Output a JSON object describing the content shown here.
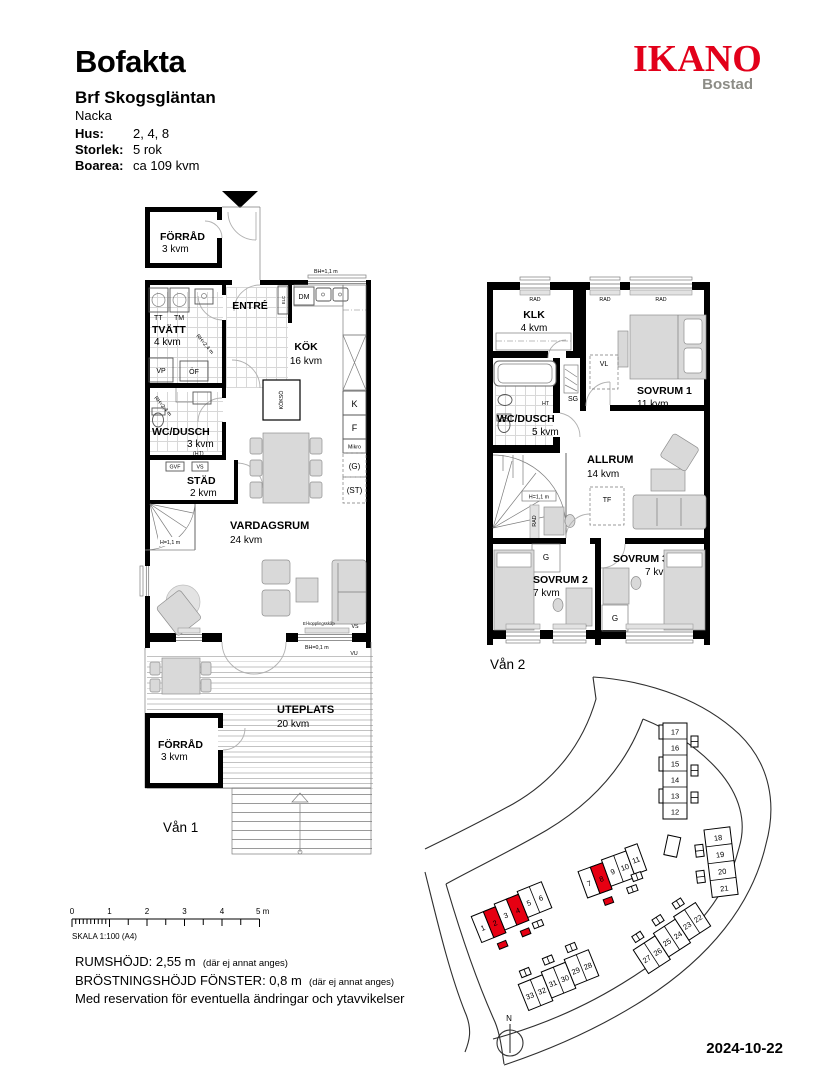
{
  "header": {
    "title": "Bofakta",
    "project": "Brf Skogsgläntan",
    "city": "Nacka",
    "fields": [
      {
        "label": "Hus:",
        "value": "2, 4, 8"
      },
      {
        "label": "Storlek:",
        "value": "5 rok"
      },
      {
        "label": "Boarea:",
        "value": "ca 109 kvm"
      }
    ]
  },
  "logo": {
    "brand": "IKANO",
    "sub": "Bostad",
    "brand_color": "#e2001a",
    "sub_color": "#8c8c86"
  },
  "colors": {
    "highlight_red": "#e60012"
  },
  "floor1": {
    "label": "Vån 1",
    "rooms": {
      "forrad_top": {
        "name": "FÖRRÅD",
        "area": "3 kvm"
      },
      "tvatt": {
        "name": "TVÄTT",
        "area": "4 kvm"
      },
      "entre": {
        "name": "ENTRÉ"
      },
      "kok": {
        "name": "KÖK",
        "area": "16 kvm"
      },
      "wc": {
        "name": "WC/DUSCH",
        "area": "3 kvm"
      },
      "stad": {
        "name": "STÄD",
        "area": "2 kvm"
      },
      "vardagsrum": {
        "name": "VARDAGSRUM",
        "area": "24 kvm"
      },
      "uteplats": {
        "name": "UTEPLATS",
        "area": "20 kvm"
      },
      "forrad_bottom": {
        "name": "FÖRRÅD",
        "area": "3 kvm"
      }
    },
    "labels": {
      "tt": "TT",
      "tm": "TM",
      "vp": "VP",
      "of": "ÖF",
      "elc": "ELC",
      "dm": "DM",
      "kokso": "KÖKSÖ",
      "bh_window": "BH=1,1 m",
      "k": "K",
      "f": "F",
      "mikro": "Mikro",
      "g": "(G)",
      "st": "(ST)",
      "ht": "(HT)",
      "gvf": "GVF",
      "vs_small": "VS",
      "rh1": "RH=2,4 m",
      "rh2": "RH=2,4 m",
      "stair_h": "H=1,1 m",
      "vs": "VS",
      "vu": "VU",
      "bh_low": "BH=0,1 m",
      "el_note": "El-kopplingsskåp"
    }
  },
  "floor2": {
    "label": "Vån 2",
    "rooms": {
      "klk": {
        "name": "KLK",
        "area": "4 kvm"
      },
      "sovrum1": {
        "name": "SOVRUM 1",
        "area": "11 kvm"
      },
      "wc": {
        "name": "WC/DUSCH",
        "area": "5 kvm"
      },
      "allrum": {
        "name": "ALLRUM",
        "area": "14 kvm"
      },
      "sovrum2": {
        "name": "SOVRUM 2",
        "area": "7 kvm"
      },
      "sovrum3": {
        "name": "SOVRUM 3",
        "area": "7 kvm"
      }
    },
    "labels": {
      "rad": "RAD",
      "vl": "VL",
      "sg": "SG",
      "ht": "HT",
      "tf": "TF",
      "g": "G",
      "stair_h": "H=1,1 m"
    }
  },
  "siteplan": {
    "north": "N",
    "highlighted_units": [
      "2",
      "4",
      "8"
    ],
    "rows": [
      {
        "units": [
          "1",
          "2",
          "3",
          "4",
          "5",
          "6"
        ]
      },
      {
        "units": [
          "7",
          "8",
          "9",
          "10",
          "11"
        ]
      },
      {
        "units": [
          "17",
          "16",
          "15",
          "14",
          "13",
          "12"
        ]
      },
      {
        "units": [
          "18",
          "19",
          "20",
          "21"
        ]
      },
      {
        "units": [
          "27",
          "26",
          "25",
          "24",
          "23",
          "22"
        ]
      },
      {
        "units": [
          "33",
          "32",
          "31",
          "30",
          "29",
          "28"
        ]
      }
    ]
  },
  "scalebar": {
    "ticks": [
      "0",
      "1",
      "2",
      "3",
      "4",
      "5 m"
    ],
    "label": "SKALA 1:100 (A4)"
  },
  "footer": {
    "line1": "RUMSHÖJD: 2,55 m",
    "note1": "(där ej annat anges)",
    "line2": "BRÖSTNINGSHÖJD FÖNSTER: 0,8 m",
    "note2": "(där ej annat anges)",
    "line3": "Med reservation för eventuella ändringar och ytavvikelser"
  },
  "date": "2024-10-22"
}
